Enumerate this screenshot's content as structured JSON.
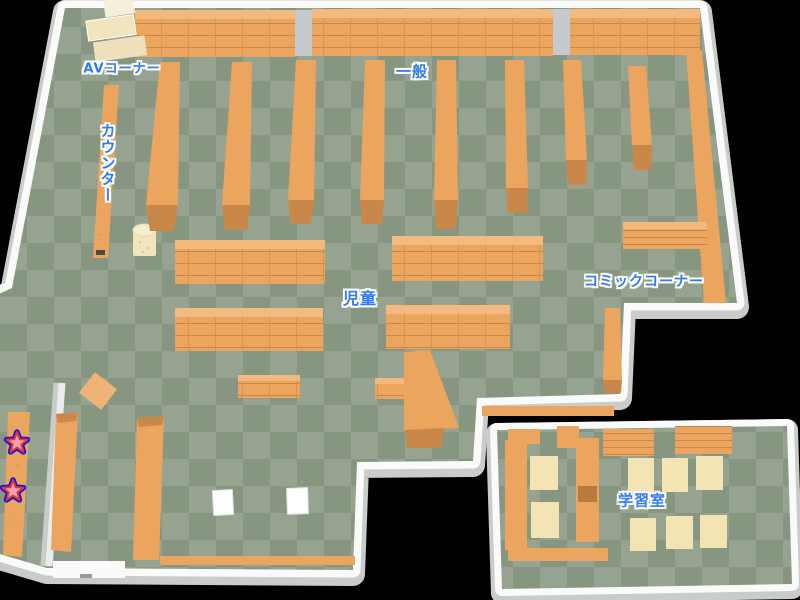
{
  "colors": {
    "bg": "#000000",
    "floor-a": "#96a390",
    "floor-b": "#879681",
    "wall": "#fafafa",
    "wall-shadow": "#c9cdc9",
    "shelf": "#eca55f",
    "shelf-top": "#f3ba80",
    "shelf-dark": "#c9884a",
    "cream": "#f2e5be",
    "table": "#f5e4b3",
    "pillar": "#c6cace",
    "label": "#2e7bf2",
    "label-outline": "#ffffff",
    "star-blue": "#1717d8",
    "star-red": "#e03636",
    "star-pink": "#f8a0ac"
  },
  "map": {
    "kind": "library-floor-map",
    "areas": {
      "av_corner": {
        "label": "AVコーナー"
      },
      "general": {
        "label": "一般"
      },
      "counter": {
        "label": "カウンター"
      },
      "children": {
        "label": "児童"
      },
      "comic_corner": {
        "label": "コミックコーナー"
      },
      "study_room": {
        "label": "学習室"
      }
    },
    "markers": {
      "symbol": "star",
      "count": 2,
      "locations": [
        "left-wall-shelf-upper",
        "left-wall-shelf-lower"
      ]
    }
  }
}
